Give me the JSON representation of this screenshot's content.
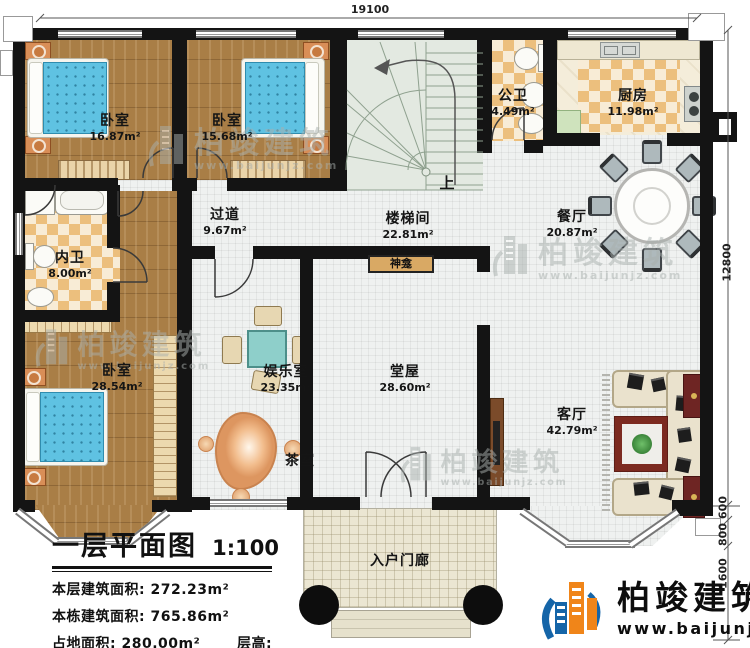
{
  "plan": {
    "rooms": {
      "bedroom1": {
        "name": "卧室",
        "area": "16.87m²"
      },
      "bedroom2": {
        "name": "卧室",
        "area": "15.68m²"
      },
      "public_bath": {
        "name": "公卫",
        "area": "4.49m²"
      },
      "kitchen": {
        "name": "厨房",
        "area": "11.98m²"
      },
      "hallway": {
        "name": "过道",
        "area": "9.67m²"
      },
      "stairwell": {
        "name": "楼梯间",
        "area": "22.81m²"
      },
      "dining": {
        "name": "餐厅",
        "area": "20.87m²"
      },
      "private_bath": {
        "name": "内卫",
        "area": "8.00m²"
      },
      "bedroom3": {
        "name": "卧室",
        "area": "28.54m²"
      },
      "entertainment": {
        "name": "娱乐室",
        "area": "23.35m²"
      },
      "hall": {
        "name": "堂屋",
        "area": "28.60m²"
      },
      "living": {
        "name": "客厅",
        "area": "42.79m²"
      },
      "tea": {
        "name": "茶室"
      },
      "porch": {
        "name": "入户门廊"
      }
    },
    "labels": {
      "shrine": "神龛",
      "stairs_up": "上"
    },
    "dimensions": {
      "top": "19100",
      "right_depth": "12800",
      "right_a": "600",
      "right_b": "800",
      "right_c": "1600"
    }
  },
  "title_block": {
    "title": "一层平面图",
    "scale": "1:100",
    "rows": [
      "本层建筑面积: 272.23m²",
      "本栋建筑面积: 765.86m²",
      "占地面积: 280.00m²",
      "层高: 3.6m"
    ]
  },
  "brand": {
    "name": "柏竣建筑",
    "url": "www.baijunjz.com"
  },
  "watermark": {
    "name": "柏竣建筑",
    "url": "www.baijunjz.com"
  },
  "colors": {
    "wall": "#141414",
    "wood": "#a97e46",
    "checker": "#ecbf7d",
    "bed": "#5fc2e2",
    "brand_blue": "#1565a8",
    "brand_orange": "#f08519",
    "shrine": "#d9a964"
  }
}
